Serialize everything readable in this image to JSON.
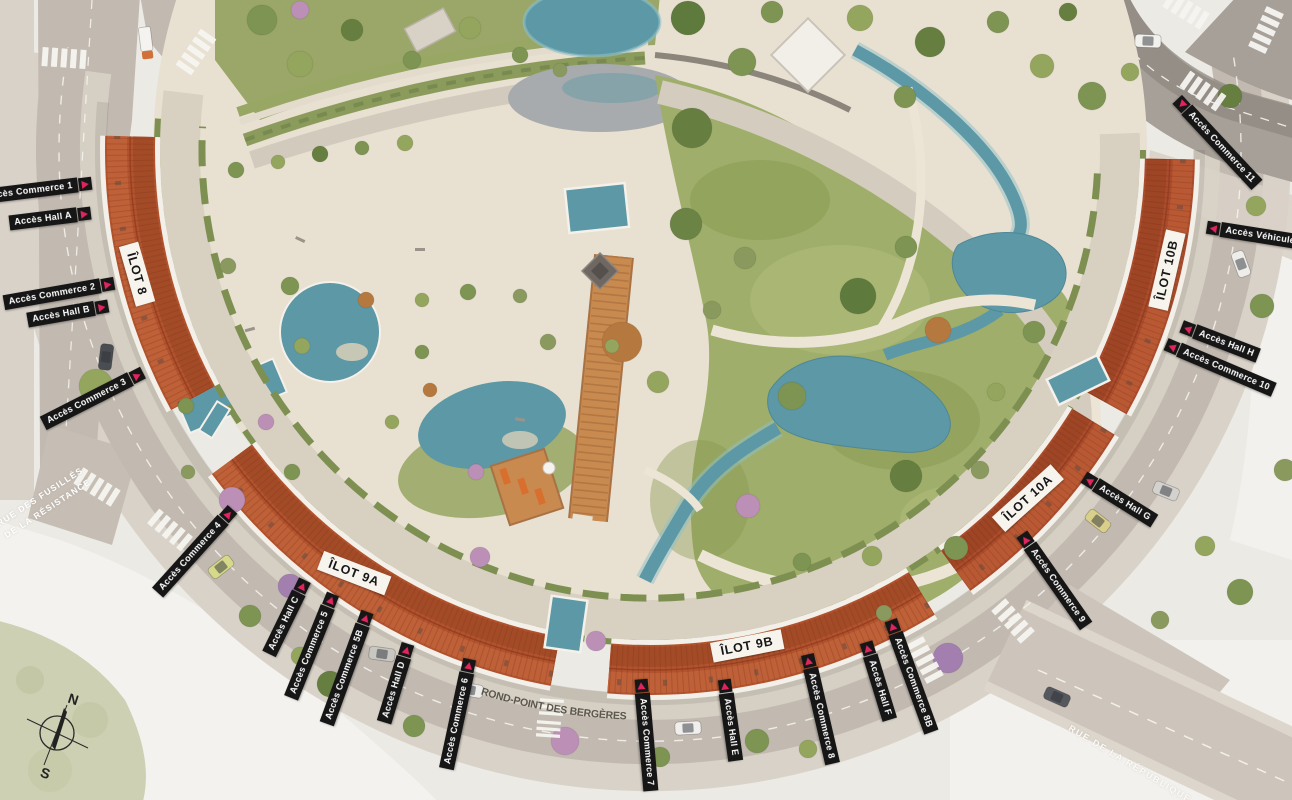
{
  "compass": {
    "north": "N",
    "south": "S"
  },
  "streets": {
    "fusilles": {
      "line1": "RUE DES FUSILLÉS",
      "line2": "DE LA RÉSISTANCE"
    },
    "rondpoint": {
      "text": "ROND-POINT DES BERGÈRES"
    },
    "republique": {
      "text": "RUE DE LA RÉPUBLIQUE"
    }
  },
  "ilots": [
    {
      "text": "ÎLOT 8",
      "x": 137,
      "y": 274,
      "rot": 74
    },
    {
      "text": "ÎLOT 9A",
      "x": 354,
      "y": 573,
      "rot": 21
    },
    {
      "text": "ÎLOT 9B",
      "x": 747,
      "y": 646,
      "rot": -11
    },
    {
      "text": "ÎLOT 10A",
      "x": 1028,
      "y": 498,
      "rot": -42
    },
    {
      "text": "ÎLOT 10B",
      "x": 1167,
      "y": 270,
      "rot": -77
    }
  ],
  "access": [
    {
      "text": "Accès Commerce 1",
      "x": 36,
      "y": 190,
      "rot": -7,
      "arrow": "end"
    },
    {
      "text": "Accès Hall A",
      "x": 50,
      "y": 218,
      "rot": -7,
      "arrow": "end"
    },
    {
      "text": "Accès Commerce 2",
      "x": 59,
      "y": 293,
      "rot": -10,
      "arrow": "end"
    },
    {
      "text": "Accès Hall B",
      "x": 68,
      "y": 313,
      "rot": -10,
      "arrow": "end"
    },
    {
      "text": "Accès Commerce 3",
      "x": 93,
      "y": 398,
      "rot": -27,
      "arrow": "end"
    },
    {
      "text": "Accès Commerce 4",
      "x": 195,
      "y": 551,
      "rot": -48,
      "arrow": "end"
    },
    {
      "text": "Accès Hall C",
      "x": 287,
      "y": 617,
      "rot": -64,
      "arrow": "end"
    },
    {
      "text": "Accès Commerce 5",
      "x": 312,
      "y": 646,
      "rot": -68,
      "arrow": "end"
    },
    {
      "text": "Accès Commerce 5B",
      "x": 347,
      "y": 668,
      "rot": -70,
      "arrow": "end"
    },
    {
      "text": "Accès Hall D",
      "x": 396,
      "y": 683,
      "rot": -73,
      "arrow": "end"
    },
    {
      "text": "Accès Commerce 6",
      "x": 458,
      "y": 714,
      "rot": -78,
      "arrow": "end"
    },
    {
      "text": "Accès Commerce 7",
      "x": 646,
      "y": 735,
      "rot": 85,
      "arrow": "start"
    },
    {
      "text": "Accès Hall E",
      "x": 730,
      "y": 720,
      "rot": 82,
      "arrow": "start"
    },
    {
      "text": "Accès Commerce 8",
      "x": 820,
      "y": 709,
      "rot": 77,
      "arrow": "start"
    },
    {
      "text": "Accès Hall F",
      "x": 878,
      "y": 681,
      "rot": 73,
      "arrow": "start"
    },
    {
      "text": "Accès Commerce 8B",
      "x": 911,
      "y": 676,
      "rot": 70,
      "arrow": "start"
    },
    {
      "text": "Accès Commerce 9",
      "x": 1054,
      "y": 580,
      "rot": 55,
      "arrow": "start"
    },
    {
      "text": "Accès Hall G",
      "x": 1119,
      "y": 499,
      "rot": 32,
      "arrow": "start"
    },
    {
      "text": "Accès Hall H",
      "x": 1220,
      "y": 341,
      "rot": 21,
      "arrow": "start"
    },
    {
      "text": "Accès Commerce 10",
      "x": 1220,
      "y": 367,
      "rot": 23,
      "arrow": "start"
    },
    {
      "text": "Accès Véhicules",
      "x": 1256,
      "y": 235,
      "rot": 9,
      "arrow": "start"
    },
    {
      "text": "Accès Commerce 11",
      "x": 1217,
      "y": 142,
      "rot": 47,
      "arrow": "start-down"
    }
  ],
  "colors": {
    "accent_arrow": "#e0245e",
    "roof": "#b2532e",
    "water": "#5d98a6",
    "park_green": "#9fae6a",
    "road": "#c2bab1",
    "label_bg": "#161616"
  }
}
